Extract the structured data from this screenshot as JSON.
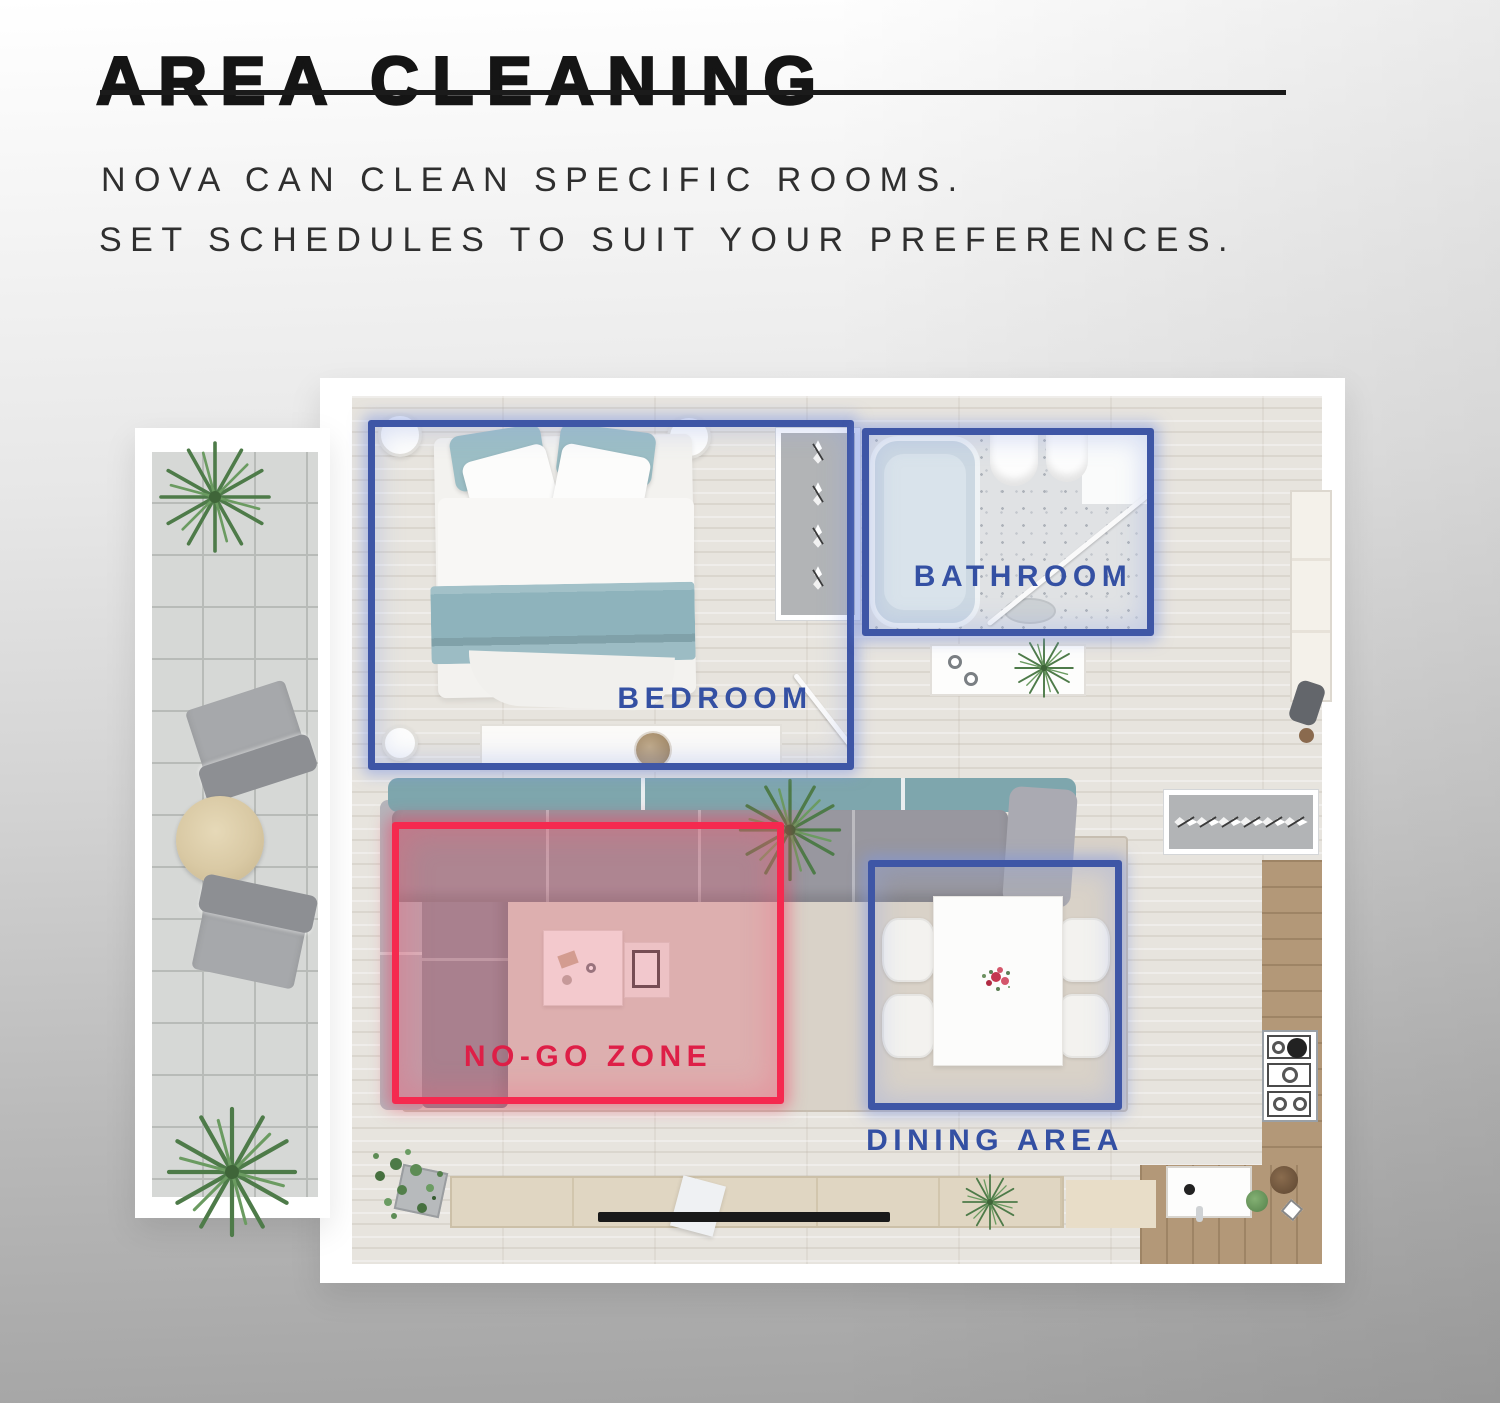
{
  "header": {
    "title": "AREA CLEANING",
    "subtitle_line1": "NOVA CAN CLEAN SPECIFIC ROOMS.",
    "subtitle_line2": "SET SCHEDULES TO SUIT YOUR PREFERENCES."
  },
  "floorplan": {
    "zones": [
      {
        "id": "bedroom",
        "label": "BEDROOM",
        "type": "room",
        "color": "#3e56a6"
      },
      {
        "id": "bathroom",
        "label": "BATHROOM",
        "type": "room",
        "color": "#3e56a6"
      },
      {
        "id": "dining-area",
        "label": "DINING AREA",
        "type": "room",
        "color": "#3e56a6"
      },
      {
        "id": "no-go-zone",
        "label": "NO-GO ZONE",
        "type": "exclusion",
        "color": "#f5294f"
      }
    ]
  },
  "colors": {
    "zone_blue": "#3e56a6",
    "zone_label_blue": "#3450a3",
    "zone_red": "#f5294f",
    "zone_label_red": "#de1f47",
    "title_text": "#151515",
    "subtitle_text": "#2f2f2f",
    "background_top": "#ffffff",
    "background_bottom": "#a3a3a3"
  }
}
